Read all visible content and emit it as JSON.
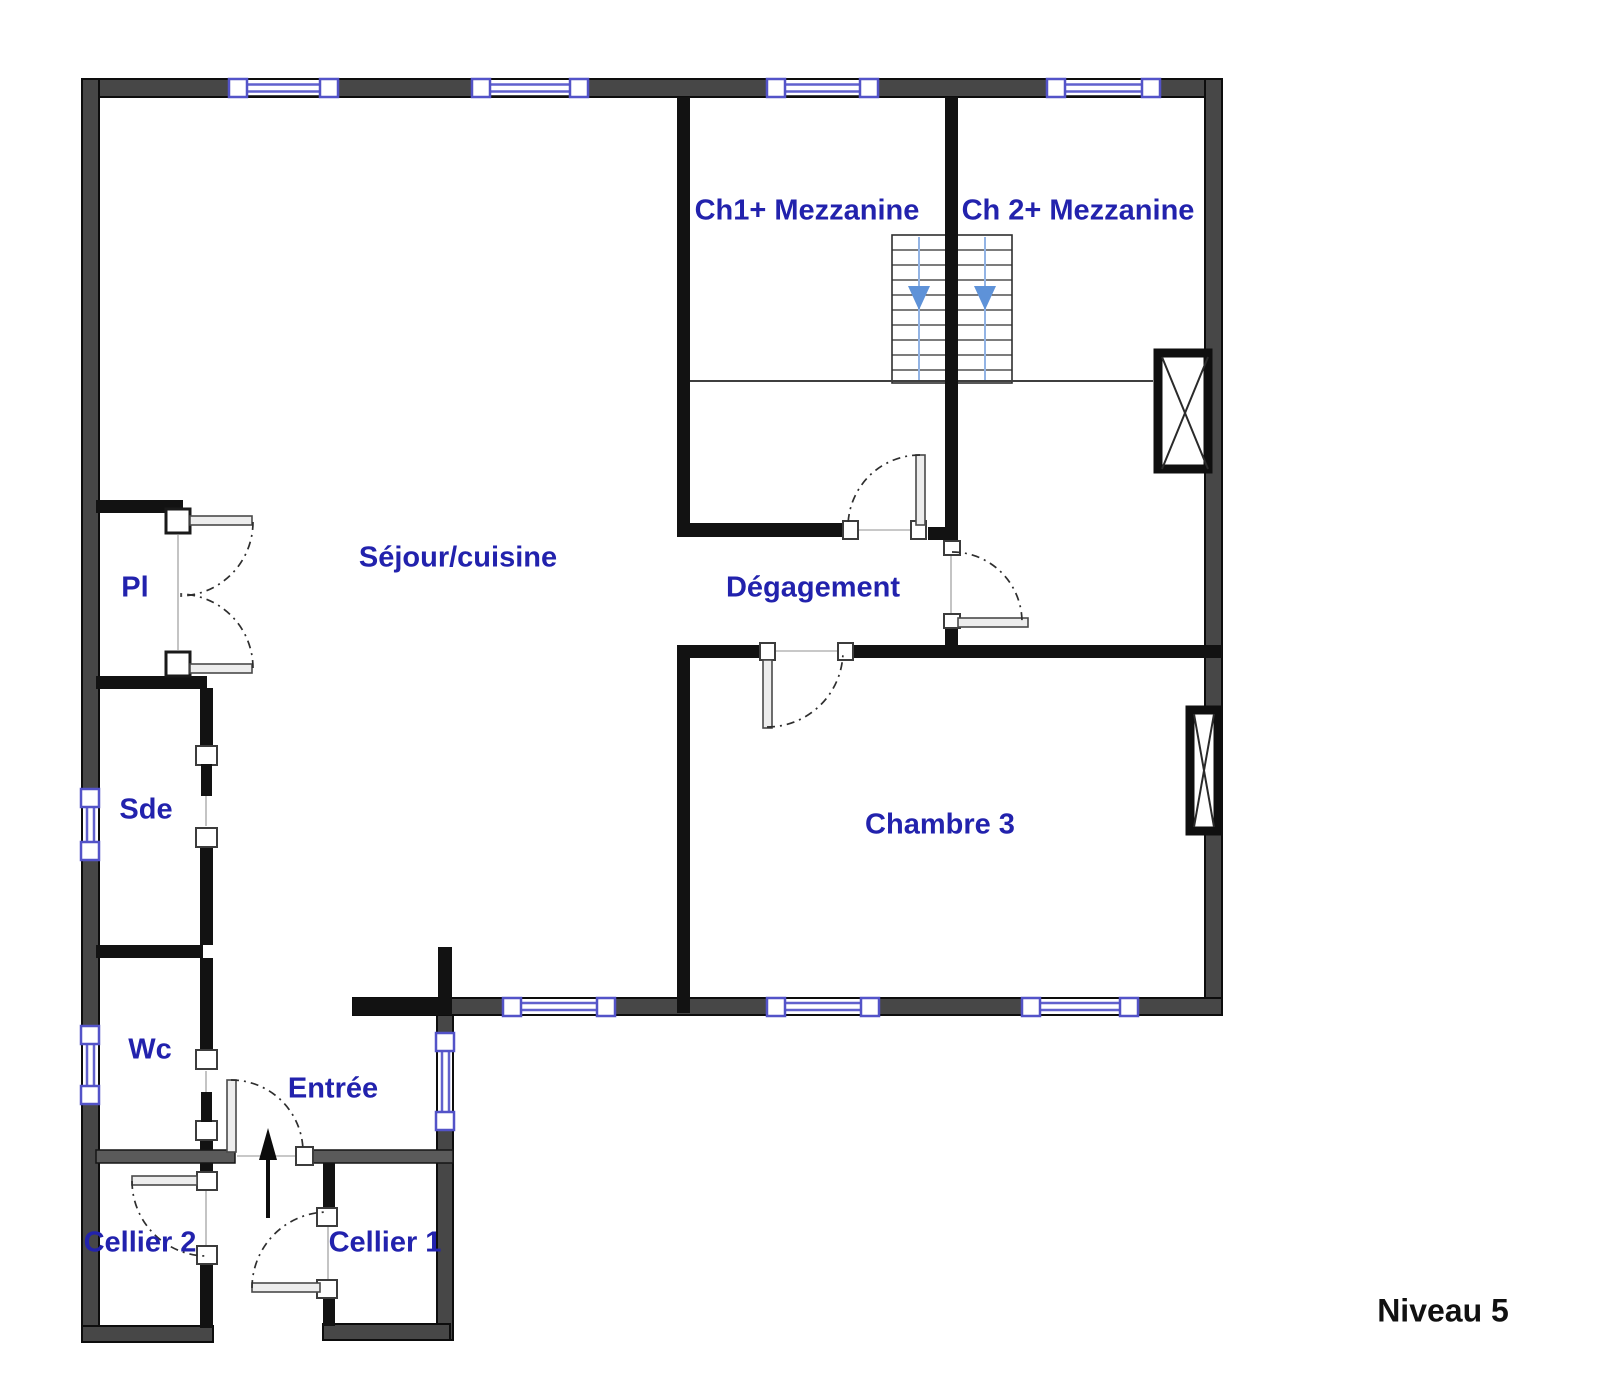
{
  "plan": {
    "level_label": "Niveau 5",
    "rooms": {
      "ch1": {
        "label": "Ch1+ Mezzanine"
      },
      "ch2": {
        "label": "Ch 2+ Mezzanine"
      },
      "sejour": {
        "label": "Séjour/cuisine"
      },
      "degagement": {
        "label": "Dégagement"
      },
      "pl": {
        "label": "Pl"
      },
      "sde": {
        "label": "Sde"
      },
      "wc": {
        "label": "Wc"
      },
      "entree": {
        "label": "Entrée"
      },
      "cellier2": {
        "label": "Cellier 2"
      },
      "cellier1": {
        "label": "Cellier 1"
      },
      "chambre3": {
        "label": "Chambre 3"
      }
    },
    "colors": {
      "room_label": "#2222ad",
      "level_label": "#111111",
      "window_blue": "#6161cd",
      "stair_arrow_blue": "#5e92d8",
      "wall_gray": "#474747",
      "wall_black": "#121212"
    },
    "icons": {
      "stairs_down": "stairs-down-arrow-icon",
      "entry_direction": "entry-direction-arrow-icon"
    }
  }
}
